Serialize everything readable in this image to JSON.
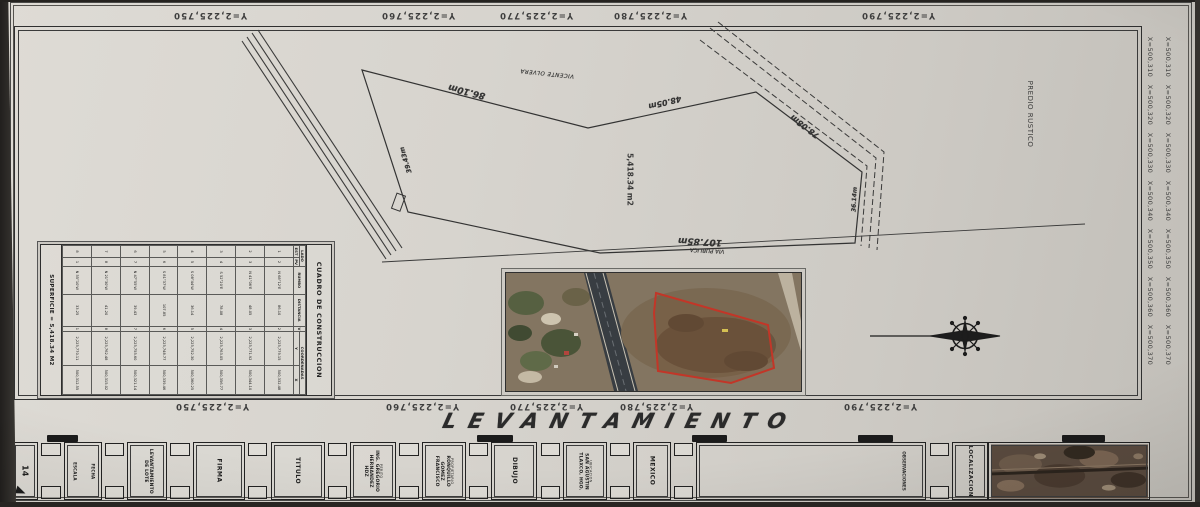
{
  "sheet": {
    "main_title": "LEVANTAMIENTO",
    "predio_label": "PREDIO RUSTICO"
  },
  "grid": {
    "y": [
      "Y=2,225,750",
      "Y=2,225,760",
      "Y=2,225,770",
      "Y=2,225,780",
      "Y=2,225,790"
    ],
    "x": [
      "X=500,310",
      "X=500,320",
      "X=500,330",
      "X=500,340",
      "X=500,350",
      "X=500,360",
      "X=500,370"
    ]
  },
  "parcel": {
    "area": "5,418.34 m2",
    "neighbor": "VICENTE OLVERA",
    "via_publica": "VIA PUBLICA",
    "edges": [
      "86.10m",
      "48.05m",
      "78.08m",
      "36.14m",
      "107.85m",
      "39.43m"
    ]
  },
  "table": {
    "title": "CUADRO DE CONSTRUCCION",
    "headers": {
      "lado": "LADO",
      "est": "EST",
      "pv": "PV",
      "rumbo": "RUMBO",
      "distancia": "DISTANCIA",
      "v": "V",
      "coordenadas": "COORDENADAS",
      "y": "Y",
      "x": "X"
    },
    "rows": [
      [
        "1",
        "2",
        "N 68°12'E",
        "86.10",
        "2",
        "2,225,779.15",
        "500,332.48"
      ],
      [
        "2",
        "3",
        "N 41°06'E",
        "48.05",
        "3",
        "2,225,771.92",
        "500,344.10"
      ],
      [
        "3",
        "4",
        "S 52°20'E",
        "78.08",
        "4",
        "2,225,763.05",
        "500,356.77"
      ],
      [
        "4",
        "5",
        "S 08°44'W",
        "36.14",
        "5",
        "2,225,752.30",
        "500,360.25"
      ],
      [
        "5",
        "6",
        "S 81°37'W",
        "107.85",
        "6",
        "2,225,748.77",
        "500,339.46"
      ],
      [
        "6",
        "7",
        "N 47°55'W",
        "39.43",
        "7",
        "2,225,755.60",
        "500,321.14"
      ],
      [
        "7",
        "8",
        "N 21°30'W",
        "41.20",
        "8",
        "2,225,762.48",
        "500,315.02"
      ],
      [
        "8",
        "1",
        "N 55°10'W",
        "33.25",
        "1",
        "2,225,770.11",
        "500,312.55"
      ]
    ],
    "footer": "SUPERFICIE = 5,418.34 M2"
  },
  "title_block": {
    "scale_box": "14",
    "small_box_line1": "ESCALA",
    "small_box_line2": "FECHA",
    "lote": "LEVANTAMIENTO DE LOTE",
    "firma": "FIRMA",
    "titulo": "TITULO",
    "perito_name": "ING. GREGORIO HERNANDEZ HDZ",
    "perito_role": "PERITO",
    "owner_name": "RONQUILLO GOMEZ FRANCISCO",
    "owner_role": "PROPIETARIO",
    "dibujo": "DIBUJO",
    "location_name": "SAN AGUSTIN TLAXCO, HGO.",
    "location_role": "UBICACION",
    "country": "MEXICO",
    "observaciones": "OBSERVACIONES",
    "localizacion": "LOCALIZACION"
  }
}
